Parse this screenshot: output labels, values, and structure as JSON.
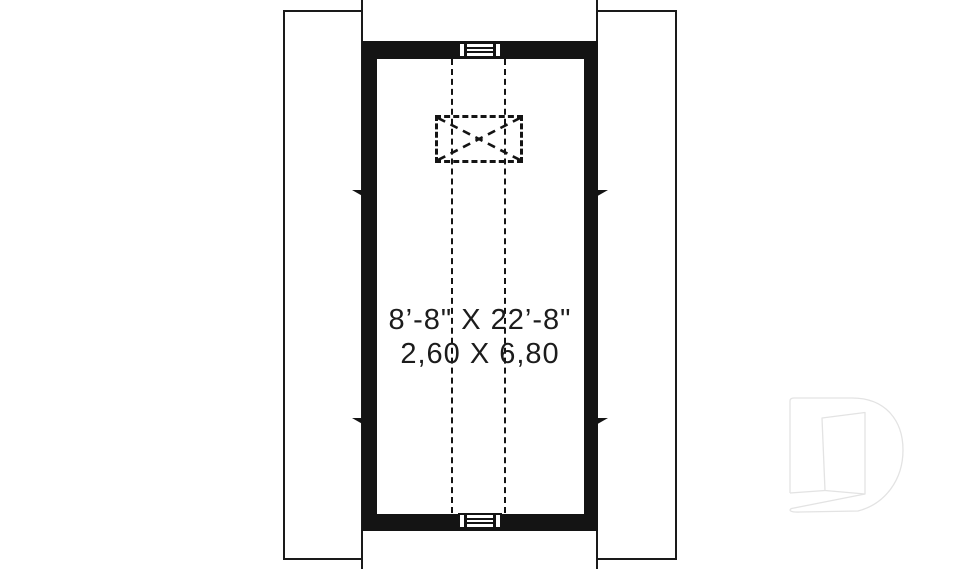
{
  "plan": {
    "title": "attic-bonus-room-floor-plan",
    "room": {
      "dimension_imperial": "8’-8\" X 22’-8\"",
      "dimension_metric": "2,60 X 6,80"
    },
    "symbols": {
      "vent_top": "louver-vent",
      "vent_bottom": "louver-vent",
      "chimney_chase": "dashed-crossed-box",
      "wall_break_marks": 4,
      "center_lines": "vertical-dashed"
    },
    "colors": {
      "wall": "#141414",
      "line": "#1a1a1a",
      "text": "#1c1c1c",
      "watermark_stroke": "#e3e3e3",
      "background": "#ffffff"
    },
    "watermark": "drummond-d-logo"
  }
}
